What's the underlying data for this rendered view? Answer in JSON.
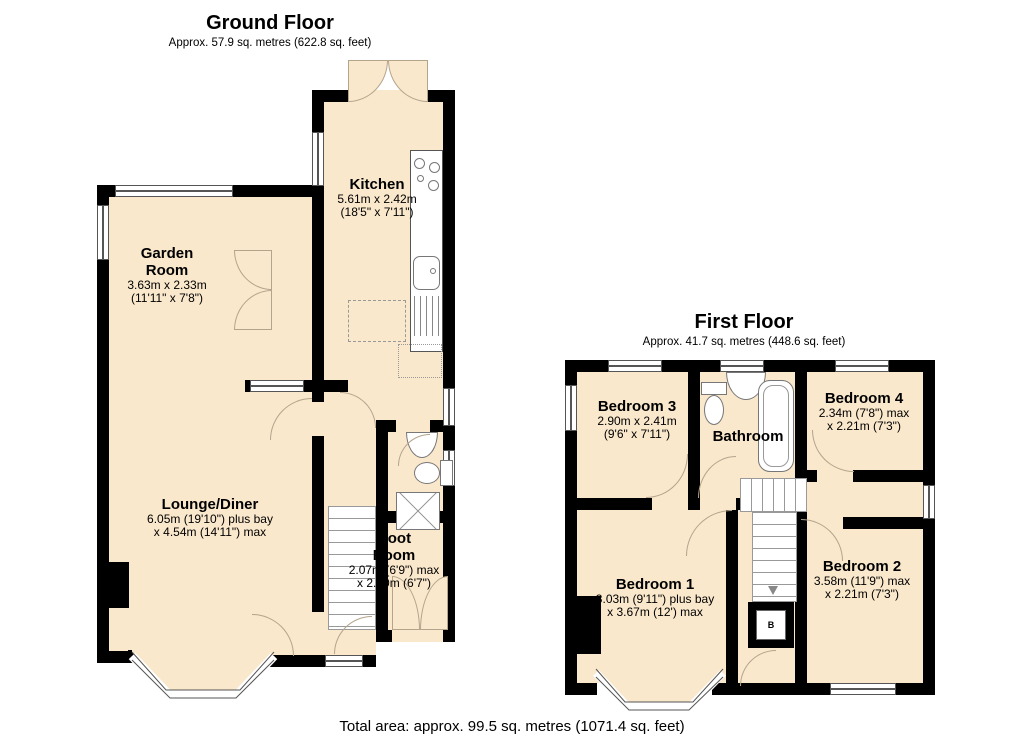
{
  "ground_floor": {
    "title": "Ground Floor",
    "subtitle": "Approx. 57.9 sq. metres (622.8 sq. feet)",
    "rooms": {
      "kitchen": {
        "name": "Kitchen",
        "dim_line1": "5.61m x 2.42m",
        "dim_line2": "(18'5\" x 7'11\")"
      },
      "garden_room": {
        "name": "Garden Room",
        "dim_line1": "3.63m x 2.33m",
        "dim_line2": "(11'11\" x 7'8\")"
      },
      "lounge_diner": {
        "name": "Lounge/Diner",
        "dim_line1": "6.05m (19'10\") plus bay",
        "dim_line2": "x 4.54m (14'11\") max"
      },
      "boot_room": {
        "name": "Boot Room",
        "dim_line1": "2.07m (6'9\") max",
        "dim_line2": "x 2.00m (6'7\")"
      }
    }
  },
  "first_floor": {
    "title": "First Floor",
    "subtitle": "Approx. 41.7 sq. metres (448.6 sq. feet)",
    "rooms": {
      "bedroom3": {
        "name": "Bedroom 3",
        "dim_line1": "2.90m x 2.41m",
        "dim_line2": "(9'6\" x 7'11\")"
      },
      "bathroom": {
        "name": "Bathroom",
        "dim_line1": "",
        "dim_line2": ""
      },
      "bedroom4": {
        "name": "Bedroom 4",
        "dim_line1": "2.34m (7'8\") max",
        "dim_line2": "x 2.21m (7'3\")"
      },
      "bedroom1": {
        "name": "Bedroom 1",
        "dim_line1": "3.03m (9'11\") plus bay",
        "dim_line2": "x 3.67m (12') max"
      },
      "bedroom2": {
        "name": "Bedroom 2",
        "dim_line1": "3.58m (11'9\") max",
        "dim_line2": "x 2.21m (7'3\")"
      }
    },
    "boiler_label": "B"
  },
  "footer": {
    "total_area": "Total area: approx. 99.5 sq. metres (1071.4 sq. feet)"
  },
  "colors": {
    "room_fill": "#FAE8CC",
    "wall": "#000000",
    "door_line": "#B3A48C",
    "window_line": "#555555"
  }
}
